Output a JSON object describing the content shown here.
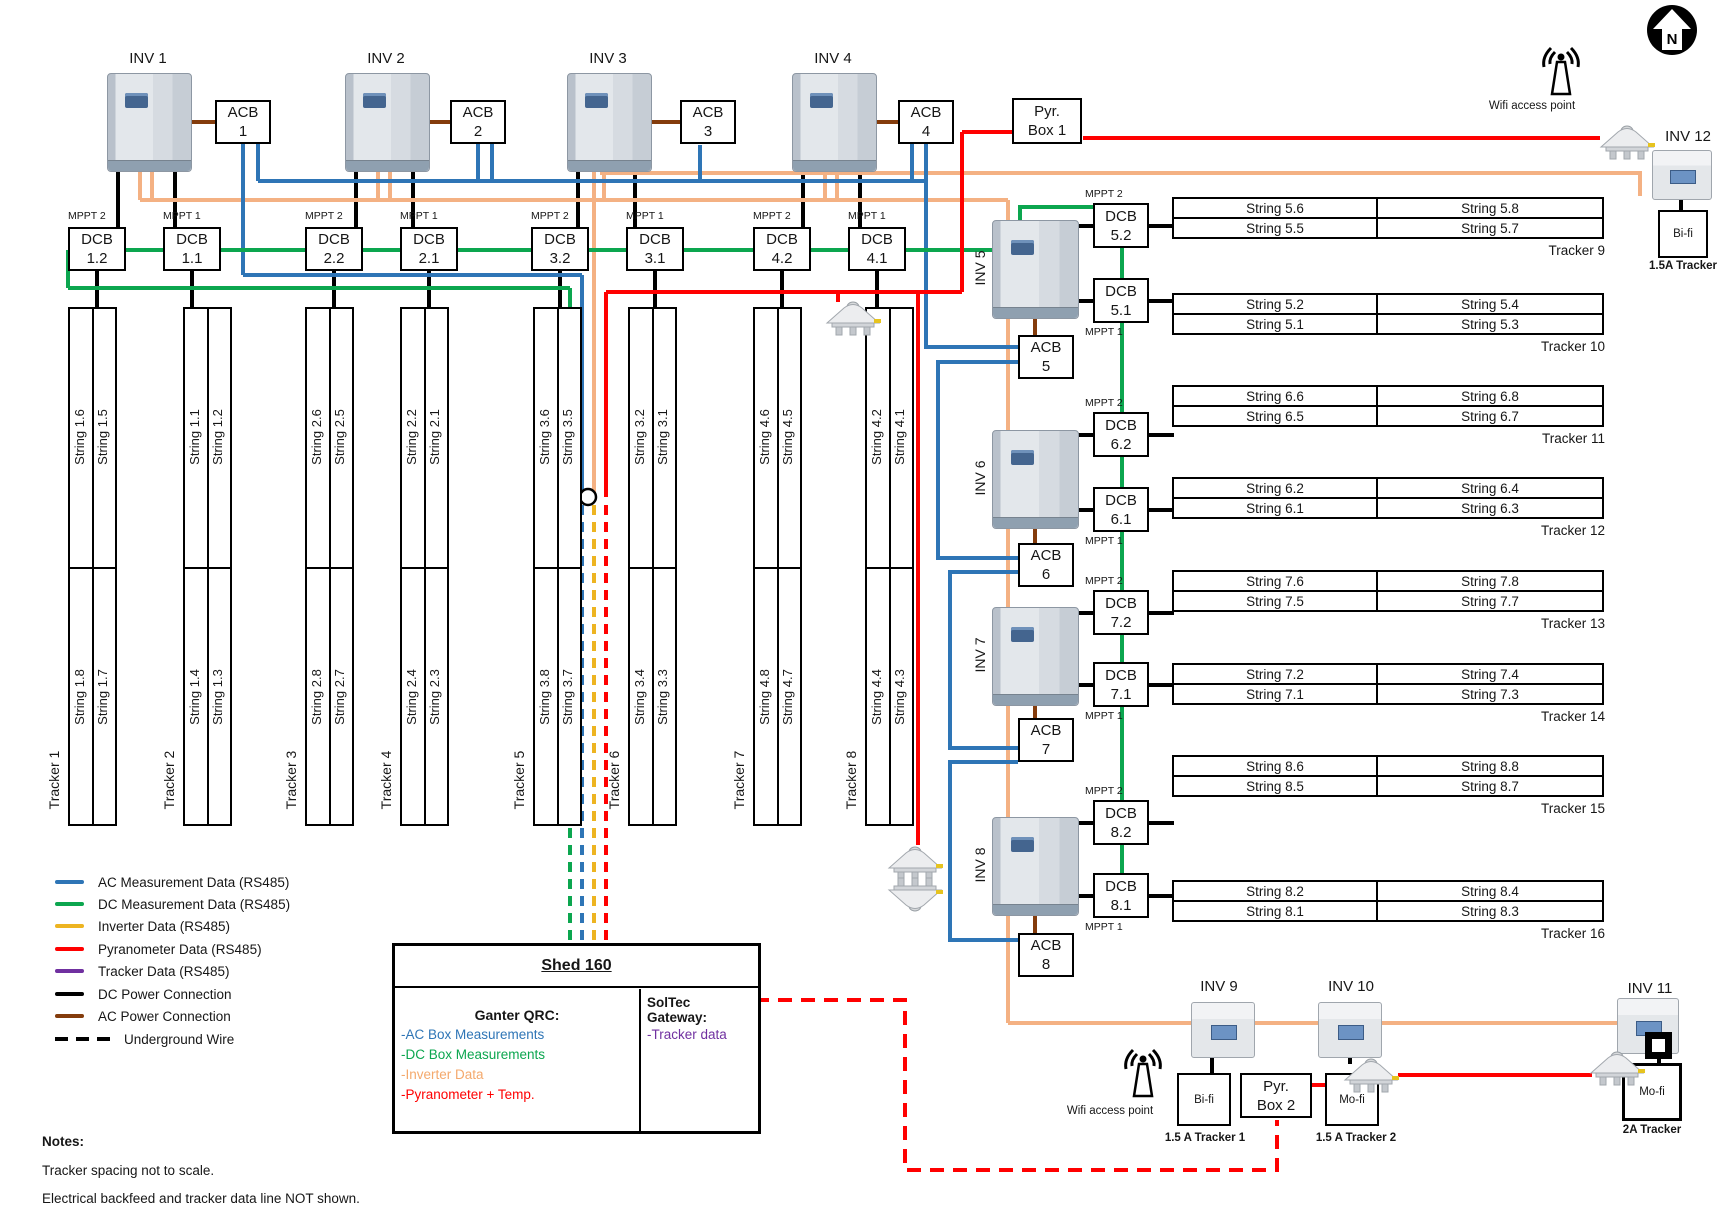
{
  "colors": {
    "wire_orange": "#f4b183"
  },
  "legend": {
    "items": [
      {
        "label": "AC Measurement Data (RS485)",
        "color": "#2e75b6",
        "style": "solid"
      },
      {
        "label": "DC Measurement Data (RS485)",
        "color": "#0ca64f",
        "style": "solid"
      },
      {
        "label": "Inverter Data (RS485)",
        "color": "#edb421",
        "style": "solid"
      },
      {
        "label": "Pyranometer Data (RS485)",
        "color": "#ff0000",
        "style": "solid"
      },
      {
        "label": "Tracker Data (RS485)",
        "color": "#7030a0",
        "style": "solid"
      },
      {
        "label": "DC Power Connection",
        "color": "#000000",
        "style": "solid"
      },
      {
        "label": "AC Power Connection",
        "color": "#843c0c",
        "style": "solid"
      },
      {
        "label": "Underground Wire",
        "color": "#000000",
        "style": "dashed"
      }
    ]
  },
  "inverters_top": [
    {
      "label": "INV 1"
    },
    {
      "label": "INV 2"
    },
    {
      "label": "INV 3"
    },
    {
      "label": "INV 4"
    }
  ],
  "acbs_top": [
    {
      "title": "ACB",
      "num": "1"
    },
    {
      "title": "ACB",
      "num": "2"
    },
    {
      "title": "ACB",
      "num": "3"
    },
    {
      "title": "ACB",
      "num": "4"
    }
  ],
  "pyr_box1": {
    "line1": "Pyr.",
    "line2": "Box 1"
  },
  "dcbs_top": [
    {
      "title": "DCB",
      "num": "1.2",
      "mppt": "MPPT 2"
    },
    {
      "title": "DCB",
      "num": "1.1",
      "mppt": "MPPT 1"
    },
    {
      "title": "DCB",
      "num": "2.2",
      "mppt": "MPPT 2"
    },
    {
      "title": "DCB",
      "num": "2.1",
      "mppt": "MPPT 1"
    },
    {
      "title": "DCB",
      "num": "3.2",
      "mppt": "MPPT 2"
    },
    {
      "title": "DCB",
      "num": "3.1",
      "mppt": "MPPT 1"
    },
    {
      "title": "DCB",
      "num": "4.2",
      "mppt": "MPPT 2"
    },
    {
      "title": "DCB",
      "num": "4.1",
      "mppt": "MPPT 1"
    }
  ],
  "trackers_left": [
    {
      "name": "Tracker 1",
      "top": [
        "String 1.6",
        "String 1.5"
      ],
      "bottom": [
        "String 1.8",
        "String 1.7"
      ]
    },
    {
      "name": "Tracker 2",
      "top": [
        "String 1.1",
        "String 1.2"
      ],
      "bottom": [
        "String 1.4",
        "String 1.3"
      ]
    },
    {
      "name": "Tracker 3",
      "top": [
        "String 2.6",
        "String 2.5"
      ],
      "bottom": [
        "String 2.8",
        "String 2.7"
      ]
    },
    {
      "name": "Tracker 4",
      "top": [
        "String 2.2",
        "String 2.1"
      ],
      "bottom": [
        "String 2.4",
        "String 2.3"
      ]
    },
    {
      "name": "Tracker 5",
      "top": [
        "String 3.6",
        "String 3.5"
      ],
      "bottom": [
        "String 3.8",
        "String 3.7"
      ]
    },
    {
      "name": "Tracker 6",
      "top": [
        "String 3.2",
        "String 3.1"
      ],
      "bottom": [
        "String 3.4",
        "String 3.3"
      ]
    },
    {
      "name": "Tracker 7",
      "top": [
        "String 4.6",
        "String 4.5"
      ],
      "bottom": [
        "String 4.8",
        "String 4.7"
      ]
    },
    {
      "name": "Tracker 8",
      "top": [
        "String 4.2",
        "String 4.1"
      ],
      "bottom": [
        "String 4.4",
        "String 4.3"
      ]
    }
  ],
  "right_column": [
    {
      "label": "INV 5",
      "acb": {
        "title": "ACB",
        "num": "5"
      },
      "dcb_top": {
        "title": "DCB",
        "num": "5.2",
        "mppt": "MPPT 2"
      },
      "dcb_bottom": {
        "title": "DCB",
        "num": "5.1",
        "mppt": "MPPT 1"
      }
    },
    {
      "label": "INV 6",
      "acb": {
        "title": "ACB",
        "num": "6"
      },
      "dcb_top": {
        "title": "DCB",
        "num": "6.2",
        "mppt": "MPPT 2"
      },
      "dcb_bottom": {
        "title": "DCB",
        "num": "6.1",
        "mppt": "MPPT 1"
      }
    },
    {
      "label": "INV 7",
      "acb": {
        "title": "ACB",
        "num": "7"
      },
      "dcb_top": {
        "title": "DCB",
        "num": "7.2",
        "mppt": "MPPT 2"
      },
      "dcb_bottom": {
        "title": "DCB",
        "num": "7.1",
        "mppt": "MPPT 1"
      }
    },
    {
      "label": "INV 8",
      "acb": {
        "title": "ACB",
        "num": "8"
      },
      "dcb_top": {
        "title": "DCB",
        "num": "8.2",
        "mppt": "MPPT 2"
      },
      "dcb_bottom": {
        "title": "DCB",
        "num": "8.1",
        "mppt": "MPPT 1"
      }
    }
  ],
  "tables_right": [
    {
      "row1": [
        "String 5.6",
        "String 5.8"
      ],
      "row2": [
        "String 5.5",
        "String 5.7"
      ],
      "tracker": "Tracker 9"
    },
    {
      "row1": [
        "String 5.2",
        "String 5.4"
      ],
      "row2": [
        "String 5.1",
        "String 5.3"
      ],
      "tracker": "Tracker 10"
    },
    {
      "row1": [
        "String 6.6",
        "String 6.8"
      ],
      "row2": [
        "String 6.5",
        "String 6.7"
      ],
      "tracker": "Tracker 11"
    },
    {
      "row1": [
        "String 6.2",
        "String 6.4"
      ],
      "row2": [
        "String 6.1",
        "String 6.3"
      ],
      "tracker": "Tracker 12"
    },
    {
      "row1": [
        "String 7.6",
        "String 7.8"
      ],
      "row2": [
        "String 7.5",
        "String 7.7"
      ],
      "tracker": "Tracker 13"
    },
    {
      "row1": [
        "String 7.2",
        "String 7.4"
      ],
      "row2": [
        "String 7.1",
        "String 7.3"
      ],
      "tracker": "Tracker 14"
    },
    {
      "row1": [
        "String 8.6",
        "String 8.8"
      ],
      "row2": [
        "String 8.5",
        "String 8.7"
      ],
      "tracker": "Tracker 15"
    },
    {
      "row1": [
        "String 8.2",
        "String 8.4"
      ],
      "row2": [
        "String 8.1",
        "String 8.3"
      ],
      "tracker": "Tracker 16"
    }
  ],
  "top_right": {
    "wifi_label": "Wifi access point",
    "compass_letter": "N",
    "inv12_label": "INV 12",
    "bifi_label": "Bi-fi",
    "bifi_sub": "1.5A Tracker"
  },
  "bottom": {
    "inv9_label": "INV 9",
    "inv10_label": "INV 10",
    "inv11_label": "INV 11",
    "wifi_label": "Wifi access point",
    "bifi_label": "Bi-fi",
    "bifi_sub": "1.5 A Tracker 1",
    "pyr_box2": {
      "line1": "Pyr.",
      "line2": "Box 2"
    },
    "mofi1_label": "Mo-fi",
    "mofi1_sub": "1.5 A Tracker 2",
    "mofi2_label": "Mo-fi",
    "mofi2_sub": "2A Tracker"
  },
  "shed": {
    "title": "Shed 160",
    "left_title": "Ganter QRC:",
    "left_items": [
      {
        "text": "-AC Box Measurements",
        "color": "#2e75b6"
      },
      {
        "text": "-DC Box Measurements",
        "color": "#0ca64f"
      },
      {
        "text": "-Inverter Data",
        "color": "#f4a96d"
      },
      {
        "text": "-Pyranometer + Temp.",
        "color": "#ff0000"
      }
    ],
    "right_title": "SolTec Gateway:",
    "right_items": [
      {
        "text": "-Tracker data",
        "color": "#7030a0"
      }
    ]
  },
  "notes": {
    "title": "Notes:",
    "line1": "Tracker spacing not to scale.",
    "line2": "Electrical backfeed and tracker data line NOT shown."
  }
}
